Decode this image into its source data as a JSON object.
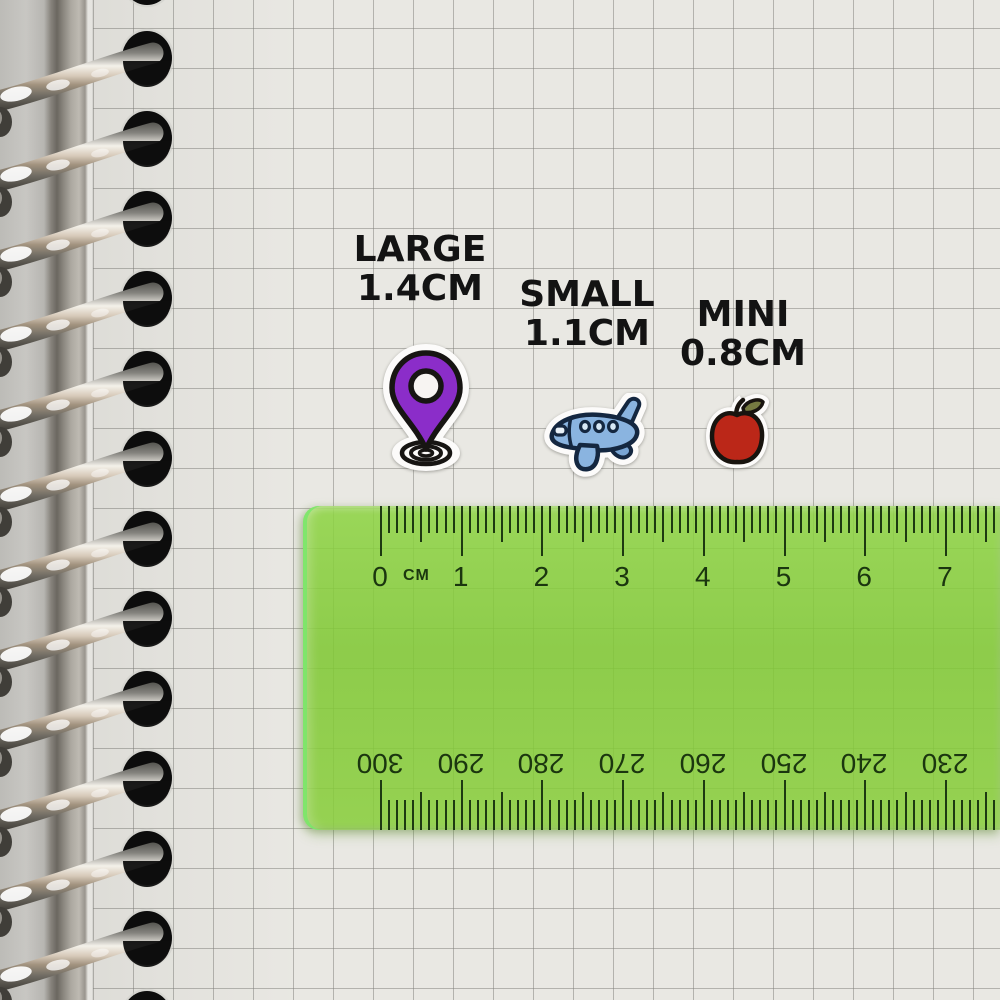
{
  "scene": {
    "description": "Photo of sticker size options on a squared spiral notebook page measured with a green ruler",
    "paper_color": "#e9e8e3",
    "grid_color": "#aeadaa"
  },
  "size_labels": [
    {
      "id": "large",
      "name_text": "LARGE",
      "size_text": "1.4CM"
    },
    {
      "id": "small",
      "name_text": "SMALL",
      "size_text": "1.1CM"
    },
    {
      "id": "mini",
      "name_text": "MINI",
      "size_text": "0.8CM"
    }
  ],
  "stickers": [
    {
      "icon": "location-pin-icon",
      "size_label": "LARGE 1.4CM",
      "main_color": "#8b2dc9"
    },
    {
      "icon": "airplane-icon",
      "size_label": "SMALL 1.1CM",
      "main_color": "#8ab4e0"
    },
    {
      "icon": "apple-icon",
      "size_label": "MINI 0.8CM",
      "main_color": "#bb2718"
    }
  ],
  "ruler": {
    "unit_label": "CM",
    "top_scale_numbers": [
      "0",
      "1",
      "2",
      "3",
      "4",
      "5",
      "6",
      "7"
    ],
    "bottom_scale_numbers": [
      "300",
      "290",
      "280",
      "270",
      "260",
      "250",
      "240",
      "230"
    ],
    "body_color": "#8fc94e",
    "marking_color": "#1d3911",
    "edge_color": "#6ede5f"
  },
  "notebook": {
    "binding_type": "spiral-rings",
    "visible_ring_count": 13,
    "ring_color_stops": [
      "#4a4a45",
      "#84837e",
      "#f4f1ea",
      "#d6c9b9",
      "#a2937f",
      "#6e6a62",
      "#3b3933"
    ]
  }
}
